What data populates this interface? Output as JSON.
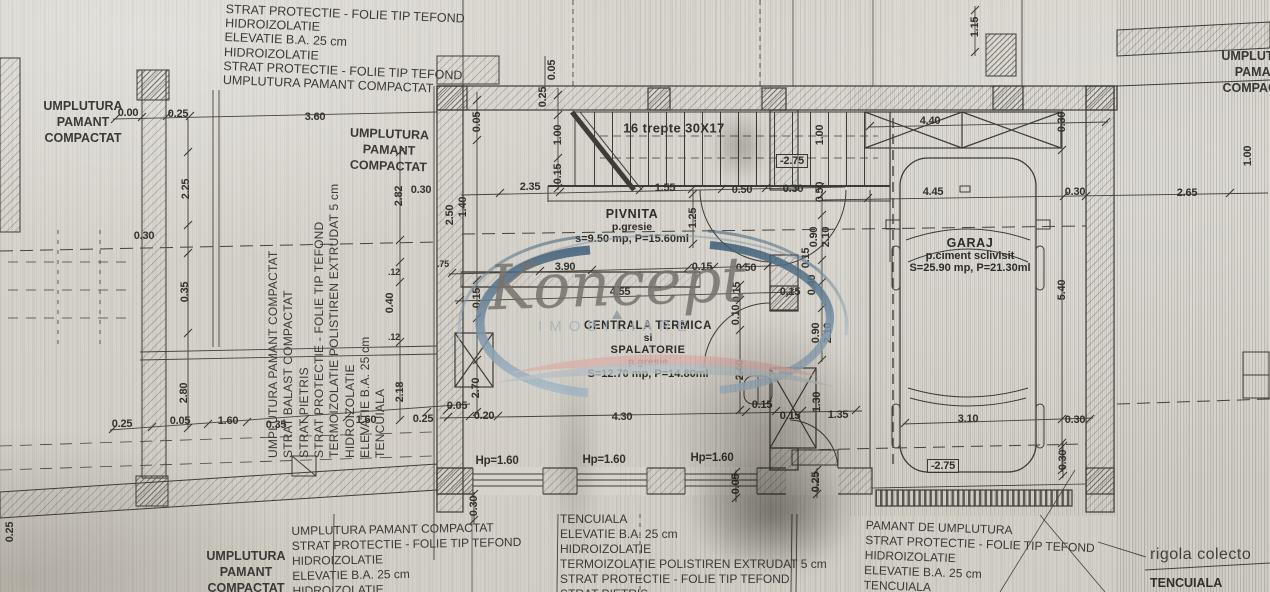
{
  "watermark": {
    "name": "Koncept",
    "subtitle": "IMOBILIARE"
  },
  "stairs_label": "16 trepte 30X17",
  "rooms": {
    "pivnita": {
      "name": "PIVNITA",
      "finish": "p.gresie",
      "area": "s=9.50 mp, P=15.60ml"
    },
    "centrala": {
      "line1": "CENTRALA TERMICA",
      "line2": "si",
      "line3": "SPALATORIE",
      "finish": "p.gresie",
      "area": "S=12.70 mp, P=14.80ml"
    },
    "garaj": {
      "name": "GARAJ",
      "finish": "p.ciment sclivisit",
      "area": "S=25.90 mp, P=21.30ml"
    }
  },
  "notes": {
    "top_left": [
      "STRAT PROTECTIE - FOLIE TIP TEFOND",
      "HIDROIZOLATIE",
      "ELEVATIE B.A. 25 cm",
      "HIDROIZOLATIE",
      "STRAT PROTECTIE - FOLIE TIP TEFOND",
      "UMPLUTURA PAMANT COMPACTAT"
    ],
    "fill": [
      "UMPLUTURA",
      "PAMANT",
      "COMPACTAT"
    ],
    "rotated_stack": [
      "UMPLUTURA PAMANT COMPACTAT",
      "STRAT BALAST COMPACTAT",
      "STRAT PIETRIS",
      "STRAT PROTECTIE - FOLIE TIP TEFOND",
      "TERMOIZOLATIE POLISTIREN EXTRUDAT 5 cm",
      "HIDROIZOLATIE",
      "ELEVATIE B.A. 25 cm",
      "TENCUIALA"
    ],
    "bottom_left_block": [
      "UMPLUTURA PAMANT COMPACTAT",
      "STRAT PROTECTIE - FOLIE TIP TEFOND",
      "HIDROIZOLATIE",
      "ELEVATIE B.A. 25 cm",
      "HIDROIZOLATIE"
    ],
    "bottom_center_block": [
      "TENCUIALA",
      "ELEVATIE B.A. 25 cm",
      "HIDROIZOLATIE",
      "TERMOIZOLATIE POLISTIREN EXTRUDAT 5 cm",
      "STRAT PROTECTIE - FOLIE TIP TEFOND",
      "STRAT PIETRIS"
    ],
    "bottom_right_block": [
      "PAMANT DE UMPLUTURA",
      "STRAT PROTECTIE - FOLIE TIP TEFOND",
      "HIDROIZOLATIE",
      "ELEVATIE B.A. 25 cm",
      "TENCUIALA"
    ],
    "rigola": "rigola colecto",
    "tencuiala_right": "TENCUIALA"
  },
  "window_labels": [
    {
      "t": "Hp=1.60",
      "x": 497,
      "y": 461
    },
    {
      "t": "Hp=1.60",
      "x": 604,
      "y": 460
    },
    {
      "t": "Hp=1.60",
      "x": 712,
      "y": 458
    }
  ],
  "dims": [
    {
      "t": "0.00",
      "x": 128,
      "y": 113
    },
    {
      "t": "0.25",
      "x": 178,
      "y": 114
    },
    {
      "t": "3.60",
      "x": 315,
      "y": 117
    },
    {
      "t": "2.25",
      "x": 186,
      "y": 189,
      "r": 1
    },
    {
      "t": "0.30",
      "x": 144,
      "y": 236
    },
    {
      "t": "0.35",
      "x": 185,
      "y": 292,
      "r": 1
    },
    {
      "t": "2.80",
      "x": 184,
      "y": 393,
      "r": 1
    },
    {
      "t": "2.82",
      "x": 399,
      "y": 196,
      "r": 1
    },
    {
      "t": "0.30",
      "x": 421,
      "y": 190
    },
    {
      "t": "0.40",
      "x": 390,
      "y": 303,
      "r": 1
    },
    {
      "t": ".12",
      "x": 394,
      "y": 272,
      "sm": 1
    },
    {
      "t": ".12",
      "x": 394,
      "y": 337,
      "sm": 1
    },
    {
      "t": "2.18",
      "x": 400,
      "y": 392,
      "r": 1
    },
    {
      "t": "0.25",
      "x": 122,
      "y": 424
    },
    {
      "t": "0.05",
      "x": 180,
      "y": 421
    },
    {
      "t": "1.60",
      "x": 228,
      "y": 421
    },
    {
      "t": "0.35",
      "x": 276,
      "y": 425
    },
    {
      "t": "1.60",
      "x": 366,
      "y": 420
    },
    {
      "t": "0.25",
      "x": 423,
      "y": 419
    },
    {
      "t": "0.05",
      "x": 457,
      "y": 406
    },
    {
      "t": "0.25",
      "x": 10,
      "y": 532,
      "r": 1
    },
    {
      "t": "0.05",
      "x": 552,
      "y": 70,
      "r": 1
    },
    {
      "t": "0.25",
      "x": 543,
      "y": 97,
      "r": 1
    },
    {
      "t": "1.00",
      "x": 558,
      "y": 135,
      "r": 1
    },
    {
      "t": "0.15",
      "x": 558,
      "y": 174,
      "r": 1
    },
    {
      "t": "0.05",
      "x": 477,
      "y": 122,
      "r": 1
    },
    {
      "t": "2.50",
      "x": 450,
      "y": 215,
      "r": 1
    },
    {
      "t": "1.40",
      "x": 463,
      "y": 207,
      "r": 1
    },
    {
      "t": "2.35",
      "x": 530,
      "y": 187
    },
    {
      "t": "1.55",
      "x": 665,
      "y": 188
    },
    {
      "t": "0.50",
      "x": 742,
      "y": 190
    },
    {
      "t": "0.30",
      "x": 793,
      "y": 189
    },
    {
      "t": "0.50",
      "x": 820,
      "y": 192,
      "r": 1
    },
    {
      "t": "1.00",
      "x": 820,
      "y": 135,
      "r": 1
    },
    {
      "t": "1.25",
      "x": 693,
      "y": 218,
      "r": 1
    },
    {
      "t": "-2.75",
      "x": 792,
      "y": 161,
      "box": 1
    },
    {
      "t": "1.15",
      "x": 975,
      "y": 27,
      "r": 1
    },
    {
      "t": "4.40",
      "x": 930,
      "y": 121
    },
    {
      "t": "0.30",
      "x": 1062,
      "y": 122,
      "r": 1
    },
    {
      "t": "4.45",
      "x": 933,
      "y": 192
    },
    {
      "t": "0.30",
      "x": 1075,
      "y": 192
    },
    {
      "t": "2.65",
      "x": 1187,
      "y": 193
    },
    {
      "t": "1.00",
      "x": 1248,
      "y": 156,
      "r": 1
    },
    {
      "t": "5.40",
      "x": 1062,
      "y": 290,
      "r": 1
    },
    {
      "t": "3.90",
      "x": 565,
      "y": 267
    },
    {
      "t": "4.55",
      "x": 620,
      "y": 292
    },
    {
      "t": "0.15",
      "x": 702,
      "y": 267
    },
    {
      "t": "0.50",
      "x": 746,
      "y": 268
    },
    {
      "t": "0.15",
      "x": 790,
      "y": 292
    },
    {
      "t": ".75",
      "x": 443,
      "y": 264,
      "sm": 1
    },
    {
      "t": "0.15",
      "x": 477,
      "y": 298,
      "r": 1
    },
    {
      "t": "2.70",
      "x": 476,
      "y": 388,
      "r": 1
    },
    {
      "t": "0.20",
      "x": 484,
      "y": 416
    },
    {
      "t": "4.30",
      "x": 622,
      "y": 417
    },
    {
      "t": "0.15",
      "x": 762,
      "y": 405
    },
    {
      "t": "0.15",
      "x": 790,
      "y": 416
    },
    {
      "t": "1.35",
      "x": 838,
      "y": 415
    },
    {
      "t": "1.30",
      "x": 817,
      "y": 402,
      "r": 1
    },
    {
      "t": "0.15",
      "x": 737,
      "y": 292,
      "r": 1
    },
    {
      "t": "0.10",
      "x": 736,
      "y": 315,
      "r": 1
    },
    {
      "t": "2.40",
      "x": 740,
      "y": 370,
      "r": 1
    },
    {
      "t": "0.90",
      "x": 814,
      "y": 237,
      "r": 1
    },
    {
      "t": "2.10",
      "x": 826,
      "y": 237,
      "r": 1
    },
    {
      "t": "0.90",
      "x": 816,
      "y": 333,
      "r": 1
    },
    {
      "t": "2.10",
      "x": 828,
      "y": 333,
      "r": 1
    },
    {
      "t": "0.15",
      "x": 806,
      "y": 258,
      "r": 1
    },
    {
      "t": "0.40",
      "x": 812,
      "y": 285,
      "r": 1
    },
    {
      "t": "3.10",
      "x": 968,
      "y": 419
    },
    {
      "t": "0.30",
      "x": 1075,
      "y": 420
    },
    {
      "t": "0.30",
      "x": 1063,
      "y": 460,
      "r": 1
    },
    {
      "t": "-2.75",
      "x": 943,
      "y": 466,
      "box": 1
    },
    {
      "t": "0.30",
      "x": 474,
      "y": 506,
      "r": 1
    },
    {
      "t": "0.05",
      "x": 736,
      "y": 484,
      "r": 1
    },
    {
      "t": "0.25",
      "x": 816,
      "y": 482,
      "r": 1
    }
  ]
}
